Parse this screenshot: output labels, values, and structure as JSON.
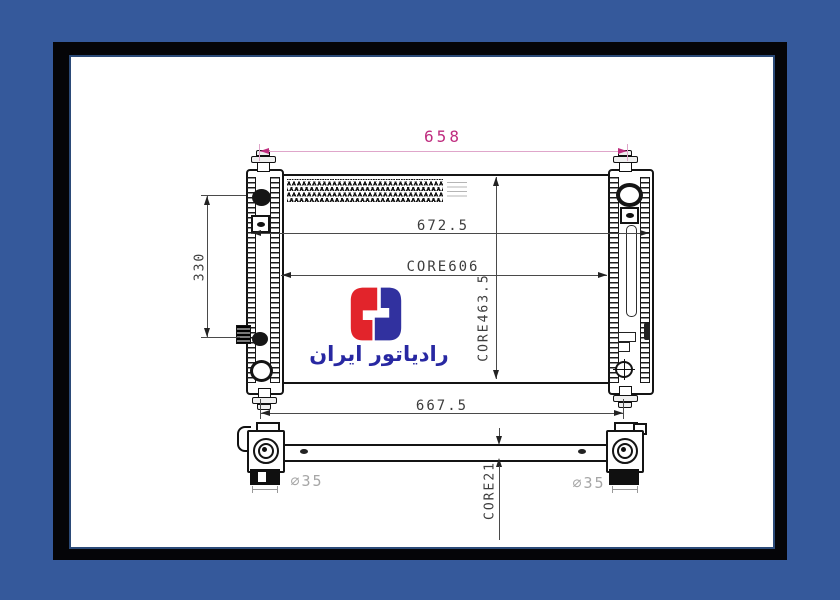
{
  "frame": {
    "outer_color": "#35599b",
    "border_color": "#050508",
    "inner_line_color": "#2b4a78",
    "paper_color": "#ffffff"
  },
  "logo": {
    "text": "رادیاتور ایران",
    "icon": "radiator-iran-mark",
    "red": "#e2242b",
    "blue": "#31319f",
    "text_color": "#2828a2"
  },
  "dimensions": {
    "top_width": "658",
    "overall_width": "672.5",
    "core_width": "CORE606",
    "left_height": "330",
    "core_height": "CORE463.5",
    "lower_width": "667.5",
    "core_thickness": "CORE21",
    "port_left": "⌀35",
    "port_right": "⌀35",
    "accent_pink": "#bf2d7f",
    "dim_text_color": "#3d3d3d",
    "port_text_color": "#a6a6a6"
  }
}
